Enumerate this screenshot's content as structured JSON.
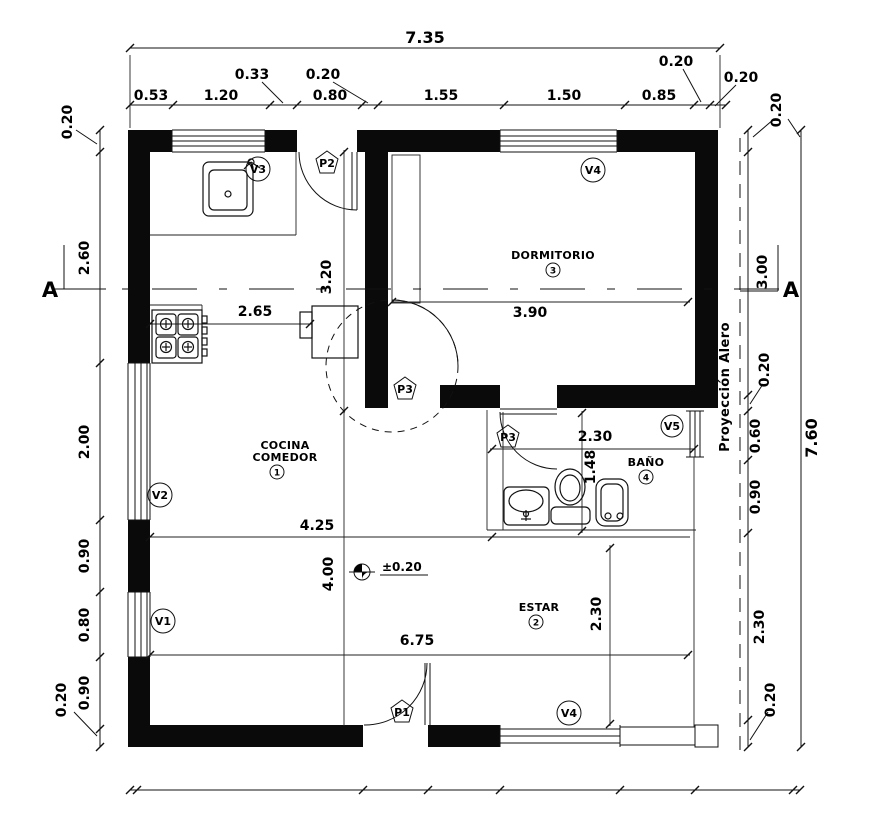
{
  "misc": {
    "section": "A",
    "alero": "Proyección Alero"
  },
  "rooms": {
    "cocina_l1": "COCINA",
    "cocina_l2": "COMEDOR",
    "cocina_n": "1",
    "estar": "ESTAR",
    "estar_n": "2",
    "dorm": "DORMITORIO",
    "dorm_n": "3",
    "bano": "BAÑO",
    "bano_n": "4"
  },
  "tags": {
    "v1": "V1",
    "v2": "V2",
    "v3": "V3",
    "v4_top": "V4",
    "v4_bottom": "V4",
    "v5": "V5",
    "p1": "P1",
    "p2": "P2",
    "p3_a": "P3",
    "p3_b": "P3"
  },
  "dims": {
    "top": {
      "overall": "7.35",
      "seg1": "0.53",
      "seg2": "1.20",
      "seg3": "0.80",
      "seg4": "1.55",
      "seg5": "1.50",
      "seg6": "0.85",
      "lead1": "0.33",
      "lead2": "0.20",
      "lead3": "0.20",
      "lead4": "0.20"
    },
    "left": {
      "top": "0.20",
      "a": "2.60",
      "b": "2.00",
      "c": "0.90",
      "d": "0.80",
      "e": "0.90",
      "bottom": "0.20"
    },
    "right": {
      "top": "0.20",
      "a": "3.00",
      "b": "0.20",
      "c": "0.60",
      "d": "0.90",
      "e": "2.30",
      "bottom": "0.20",
      "overall": "7.60"
    },
    "inner": {
      "a": "2.65",
      "b": "3.20",
      "c": "3.90",
      "d": "4.25",
      "e": "4.00",
      "f": "6.75",
      "g": "2.30",
      "h": "1.48",
      "i": "2.30",
      "level": "±0.20"
    }
  }
}
